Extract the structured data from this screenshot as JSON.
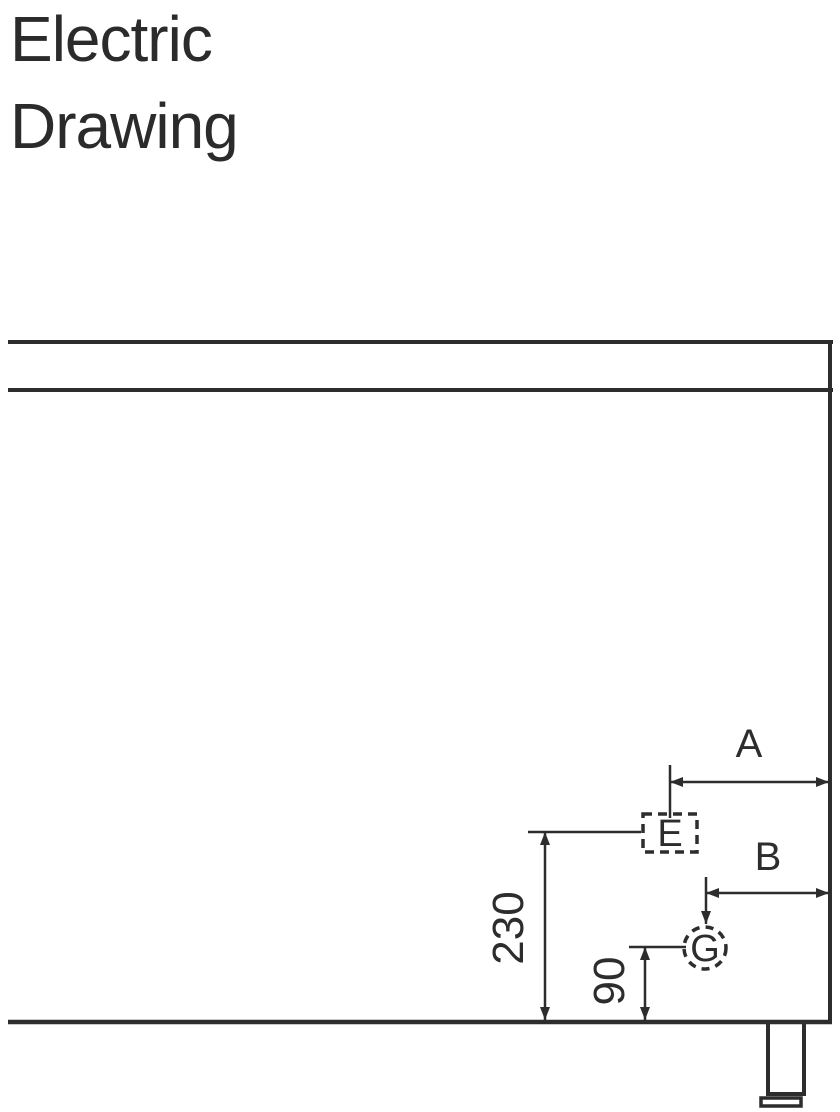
{
  "title": {
    "line1": "Electric",
    "line2": "Drawing"
  },
  "drawing": {
    "labels": {
      "dim_a": "A",
      "dim_b": "B",
      "dim_e_height": "230",
      "dim_g_height": "90",
      "electric_marker": "E",
      "gas_marker": "G"
    },
    "colors": {
      "line": "#2d2d2d",
      "text": "#2b2b2b",
      "background": "#ffffff"
    }
  }
}
